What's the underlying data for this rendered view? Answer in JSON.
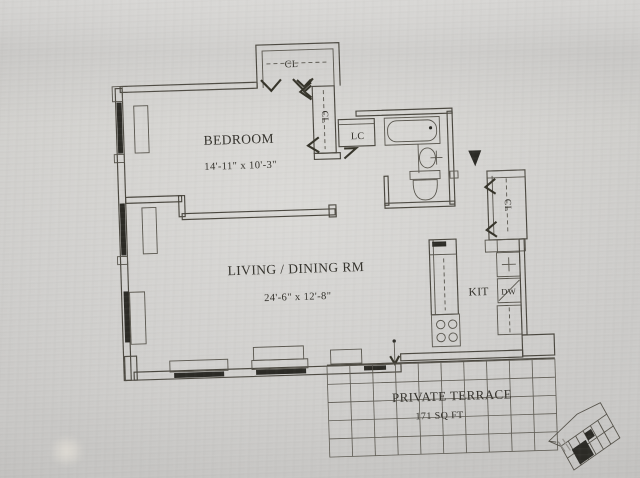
{
  "photo": {
    "background": "#cccbc9",
    "line_color": "#4a473f",
    "accent_black": "#2b2a25"
  },
  "plan": {
    "bedroom": {
      "name": "BEDROOM",
      "dims": "14'-11\" x 10'-3\""
    },
    "living": {
      "name": "LIVING / DINING RM",
      "dims": "24'-6\" x 12'-8\""
    },
    "kitchen": {
      "name": "KIT"
    },
    "terrace": {
      "name": "PRIVATE TERRACE",
      "area": "171 SQ FT"
    },
    "closets": {
      "top": "CL",
      "hall": "CL",
      "linen": "LC",
      "entry": "CL"
    },
    "appliances": {
      "dishwasher": "DW"
    },
    "icons": {
      "entry_marker": "filled-down-triangle",
      "terrace_door": "down-arrow"
    }
  }
}
